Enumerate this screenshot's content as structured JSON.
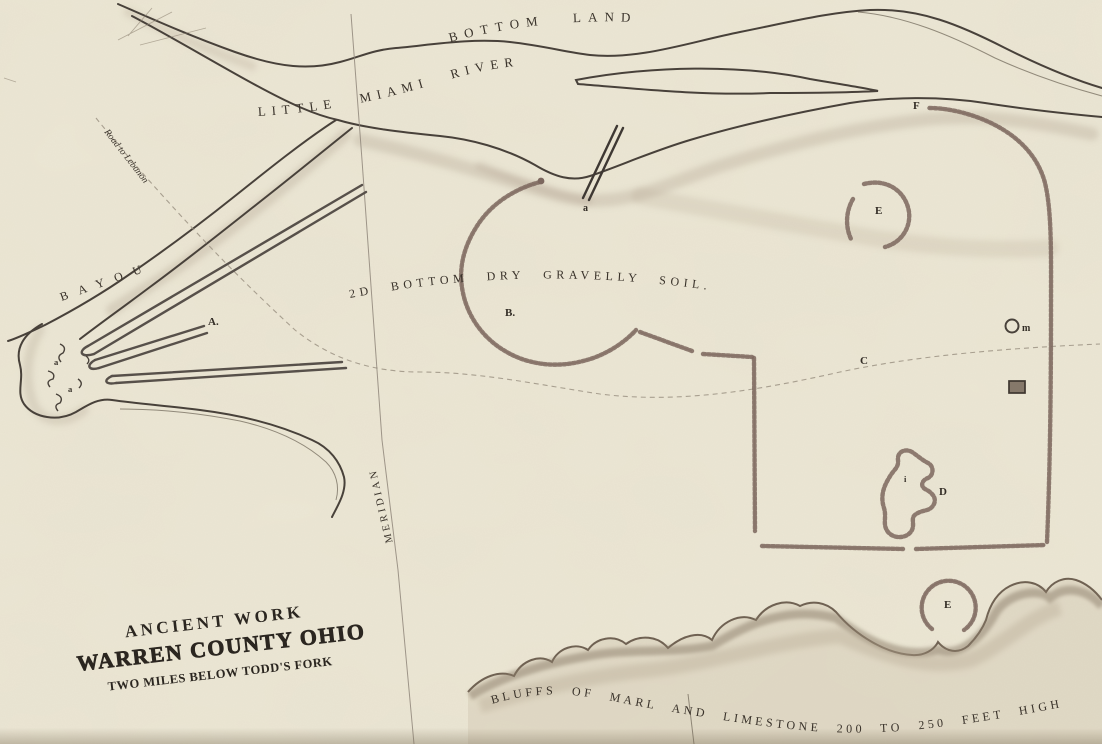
{
  "map": {
    "region_labels": {
      "bottom_land": "BOTTOM LAND",
      "river": "LITTLE MIAMI RIVER",
      "road_to_lebanon": "Road to Lebanon",
      "bayou": "BAYOU",
      "second_bottom": "2D BOTTOM  DRY  GRAVELLY  SOIL.",
      "meridian": "MERIDIAN",
      "bluffs": "BLUFFS OF MARL AND LIMESTONE 200 TO 250 FEET HIGH"
    },
    "title_block": {
      "line1": "ANCIENT WORK",
      "line2": "WARREN COUNTY OHIO",
      "line3": "TWO MILES BELOW TODD'S FORK"
    },
    "feature_markers": {
      "a_graded_ways": "A.",
      "b_great_circle": "B.",
      "c_road": "C",
      "d_mound_cluster": "D",
      "e_small_circle_upper": "E",
      "e_small_circle_lower": "E",
      "f_enclosure": "F",
      "m_small_ring": "m",
      "a_river_way": "a",
      "a_blob_1": "a",
      "a_blob_2": "a",
      "i_mark": "i"
    },
    "colors": {
      "paper": "#ece7d5",
      "ink": "#39322a",
      "earthwork": "#7c675e",
      "shading": "#b0a28e"
    }
  }
}
